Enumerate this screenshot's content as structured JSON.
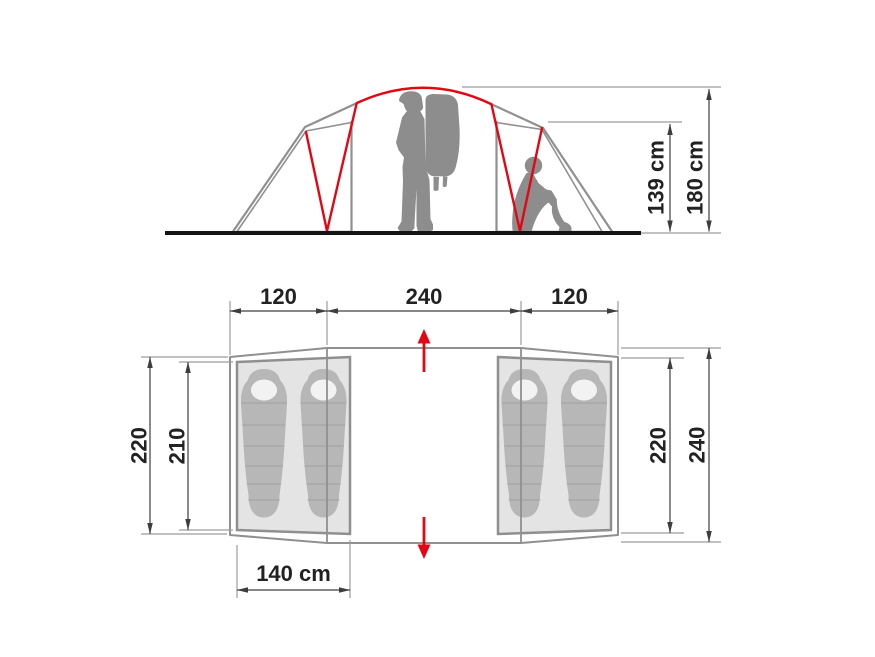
{
  "side_view": {
    "inner_height": "139 cm",
    "peak_height": "180 cm"
  },
  "floor_plan": {
    "left_width": "120",
    "center_width": "240",
    "right_width": "120",
    "left_depth": "220",
    "left_cabin_length": "210",
    "right_depth": "220",
    "center_depth": "240",
    "cabin_width": "140 cm"
  },
  "colors": {
    "accent_red": "#e30613",
    "silhouette": "#8d8d8d",
    "panel_fill": "#e6e6e6",
    "outline_gray": "#909090",
    "dimension_line": "#3d3d3d",
    "extension_line": "#9c9c9c",
    "ground": "#141414",
    "sleeping_bag": "#b7b7b7",
    "bag_hole": "#f2f2f2",
    "label_text": "#222222"
  }
}
